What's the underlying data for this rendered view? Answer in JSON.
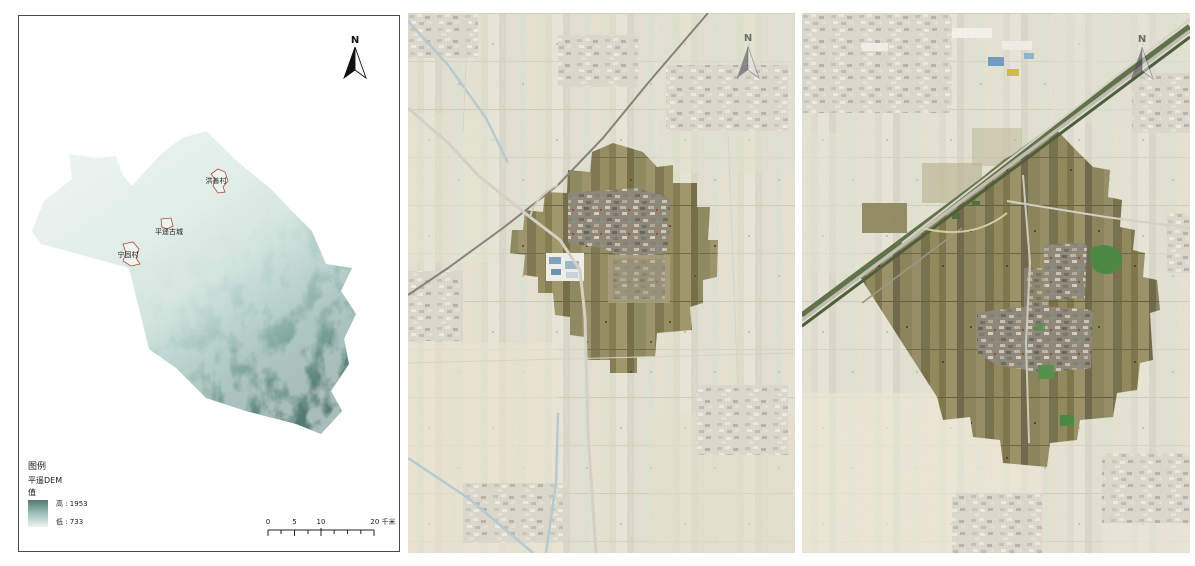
{
  "dem": {
    "north_label": "N",
    "legend_title": "图例",
    "legend_layer": "平遥DEM",
    "legend_field": "值",
    "legend_high": "高 : 1953",
    "legend_low": "低 : 733",
    "scalebar": {
      "tick0": "0",
      "tick1": "5",
      "tick2": "10",
      "tick3": "20 千米"
    },
    "labels": {
      "north_village": "洪善村",
      "ancient_city": "平遥古城",
      "southwest_village": "宁固村"
    },
    "colors": {
      "elevation_low": "#eaf3ef",
      "elevation_high": "#527a71",
      "marker_outline": "#b5463c"
    }
  },
  "mid": {
    "north_label": "N",
    "colors": {
      "highlight_fields": "#938c60",
      "faded_surround": "#e8e5d8"
    }
  },
  "right": {
    "north_label": "N",
    "colors": {
      "highlight_fields": "#8f8858",
      "faded_surround": "#e9e6db",
      "woodland": "#4a8742"
    }
  }
}
